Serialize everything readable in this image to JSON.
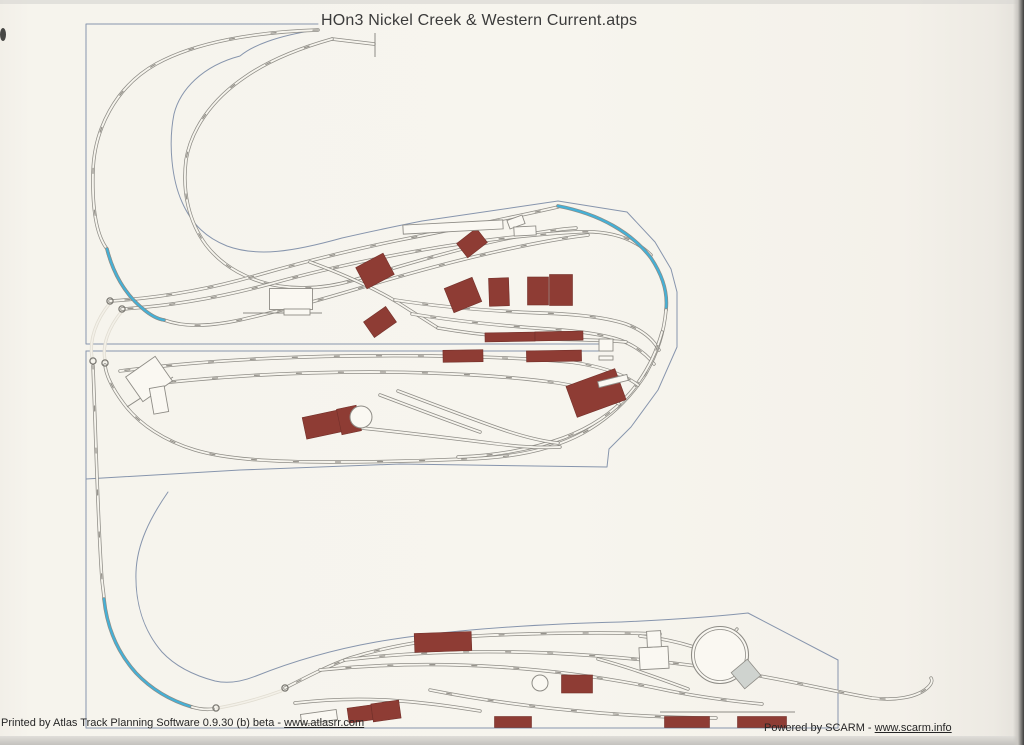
{
  "page": {
    "title": "HOn3 Nickel Creek & Western Current.atps"
  },
  "footer": {
    "left_prefix": "Printed by Atlas Track Planning Software 0.9.30 (b) beta - ",
    "left_link": "www.atlasrr.com",
    "right_prefix": "Powered by SCARM - ",
    "right_link": "www.scarm.info"
  },
  "colors": {
    "paper": "#f6f4ed",
    "paperLight": "#faf8f2",
    "rail": "#8e8c86",
    "blue": "#45b0d6",
    "ghost": "#e1ddd2",
    "ghostInner": "#f3f0e8",
    "outline": "#8795ad",
    "maroon": "#8e3c34",
    "maroonStroke": "#73302a",
    "grayFill": "#cfd3cf",
    "label": "#85817a"
  },
  "diagram": {
    "outlines": [
      {
        "d": "M 318,24 L 86,24 L 86,344 L 612,344"
      },
      {
        "d": "M 86,351 L 612,351"
      },
      {
        "d": "M 86,351 L 86,728 L 838,728 L 838,660"
      },
      {
        "d": "M 316,30 C 276,36 252,46 240,56 C 202,66 180,90 174,114 C 168,144 172,180 182,202 C 192,225 207,238 227,246 C 257,257 292,252 342,238 C 377,230 402,225 422,221 L 558,201 L 627,212 L 655,242 L 671,269 L 677,292 L 677,347 L 658,390 L 631,427 L 609,449 L 607,467 L 400,464 L 240,470 L 86,479"
      },
      {
        "d": "M 168,492 C 150,518 137,544 136,572 C 135,602 143,630 162,652 C 176,667 196,676 215,681 C 228,684 241,682 256,676 C 291,662 331,650 376,642 C 451,629 541,624 621,622 C 666,620 711,617 748,613 L 838,660"
      }
    ],
    "ghost_tracks": [
      {
        "d": "M 110,303 C 96,320 89,340 92,358"
      },
      {
        "d": "M 122,311 C 108,328 102,346 105,360"
      },
      {
        "d": "M 218,708 C 240,704 262,698 281,691"
      }
    ],
    "tracks": [
      {
        "d": "M 318,30 C 255,32 196,42 156,64 C 115,87 94,130 93,172 C 92,210 97,236 107,249 C 113,273 125,294 142,308 C 150,315 157,319 164,320 C 186,328 212,326 240,320 C 280,311 320,300 360,288 C 400,276 450,262 495,252 C 535,243 562,238 588,235",
        "k": "main",
        "labels": true
      },
      {
        "d": "M 332,39 L 374,44",
        "k": "main"
      },
      {
        "d": "M 332,39 C 300,48 268,61 245,77 C 211,100 191,130 186,160 C 182,192 189,222 206,245 C 223,267 249,281 279,286 C 306,290 331,287 354,280 C 400,266 460,248 510,238 C 540,232 560,229 576,228",
        "k": "main",
        "labels": true
      },
      {
        "d": "M 110,301 C 160,298 210,289 258,275 C 300,263 350,250 400,240 C 450,230 510,218 558,207",
        "k": "main",
        "labels": true
      },
      {
        "d": "M 122,309 C 172,306 222,297 270,284 C 320,270 380,257 440,247 C 490,239 540,234 576,232 C 610,230 634,238 651,255",
        "k": "main",
        "labels": true
      },
      {
        "d": "M 310,262 C 340,273 372,287 397,302 C 413,312 427,321 438,328",
        "k": "main"
      },
      {
        "d": "M 395,300 C 440,307 490,311 540,313 C 575,314 605,317 626,324 C 642,330 653,339 659,350",
        "k": "main",
        "labels": true
      },
      {
        "d": "M 412,314 C 455,321 505,326 548,329 C 578,331 602,334 620,340 C 636,346 647,355 654,364",
        "k": "main",
        "labels": true
      },
      {
        "d": "M 438,328 C 472,334 512,338 552,339 C 582,340 606,340 626,342",
        "k": "main"
      },
      {
        "d": "M 558,206 C 600,214 632,233 651,258 C 663,276 668,293 666,310",
        "k": "blue"
      },
      {
        "d": "M 107,249 C 113,273 125,294 142,308 C 150,315 157,319 164,320",
        "k": "blue"
      },
      {
        "d": "M 666,310 C 664,332 658,352 645,375 C 630,398 610,418 583,433 C 550,451 510,458 465,459 C 420,461 370,462 330,462 C 270,462 225,459 195,450 C 165,441 140,425 124,404 C 112,388 106,375 105,365",
        "k": "main",
        "labels": true
      },
      {
        "d": "M 662,332 C 656,354 646,374 630,393 C 613,413 590,428 563,438 C 530,450 492,456 458,457",
        "k": "main",
        "labels": true
      },
      {
        "d": "M 120,371 C 190,362 270,357 350,356 C 430,355 510,357 570,362 C 600,366 622,373 638,385",
        "k": "main",
        "labels": true
      },
      {
        "d": "M 135,386 C 210,377 290,372 370,372 C 440,372 508,376 558,383 C 584,387 604,394 619,404",
        "k": "main",
        "labels": true
      },
      {
        "d": "M 352,427 C 400,432 450,438 498,444 C 522,447 543,448 560,447",
        "k": "main"
      },
      {
        "d": "M 398,391 C 430,403 464,416 498,428 C 518,435 540,441 558,443",
        "k": "main"
      },
      {
        "d": "M 380,395 C 412,407 446,420 480,432",
        "k": "main"
      },
      {
        "d": "M 93,366 L 95,420 C 97,480 99,540 102,580 C 103,590 104,595 104,599",
        "k": "main",
        "labels": true
      },
      {
        "d": "M 104,599 C 107,628 118,653 136,673 C 153,691 172,701 192,707",
        "k": "blue"
      },
      {
        "d": "M 192,707 C 199,709 206,710 213,709",
        "k": "main"
      },
      {
        "d": "M 285,688 C 305,678 325,667 350,658 C 395,644 445,637 495,635 C 550,633 610,632 660,634",
        "k": "main",
        "labels": true
      },
      {
        "d": "M 640,636 C 660,638 678,642 694,647",
        "k": "main"
      },
      {
        "d": "M 345,660 C 410,652 480,650 550,653 C 630,657 700,665 760,676 C 800,683 842,693 872,698 C 896,701 916,697 926,689 C 931,685 933,681 931,678",
        "k": "main",
        "labels": true
      },
      {
        "d": "M 320,670 C 380,664 440,663 500,667 C 560,671 620,680 670,691 C 700,697 730,701 762,704",
        "k": "main",
        "labels": true
      },
      {
        "d": "M 430,690 C 480,700 540,708 600,713 C 640,716 682,718 716,718",
        "k": "main",
        "labels": true
      },
      {
        "d": "M 295,703 C 330,699 365,698 400,701 C 430,703 456,707 480,711",
        "k": "main"
      },
      {
        "d": "M 598,659 C 628,667 658,678 688,689",
        "k": "main"
      },
      {
        "d": "M 737,629 L 701,672",
        "k": "bridge"
      }
    ],
    "buildings": [
      {
        "cx": 472,
        "cy": 243,
        "w": 25,
        "h": 18,
        "rot": -38
      },
      {
        "cx": 375,
        "cy": 271,
        "w": 31,
        "h": 24,
        "rot": -28
      },
      {
        "cx": 463,
        "cy": 295,
        "w": 30,
        "h": 26,
        "rot": -22
      },
      {
        "cx": 499,
        "cy": 292,
        "w": 20,
        "h": 28,
        "rot": -2
      },
      {
        "cx": 538,
        "cy": 291,
        "w": 21,
        "h": 28,
        "rot": 0
      },
      {
        "cx": 561,
        "cy": 290,
        "w": 23,
        "h": 31,
        "rot": 0
      },
      {
        "cx": 380,
        "cy": 322,
        "w": 27,
        "h": 19,
        "rot": -35
      },
      {
        "cx": 510,
        "cy": 337,
        "w": 50,
        "h": 9,
        "rot": -1
      },
      {
        "cx": 559,
        "cy": 336,
        "w": 48,
        "h": 9,
        "rot": -1
      },
      {
        "cx": 463,
        "cy": 356,
        "w": 40,
        "h": 12,
        "rot": -1
      },
      {
        "cx": 554,
        "cy": 356,
        "w": 55,
        "h": 11,
        "rot": -1
      },
      {
        "cx": 596,
        "cy": 393,
        "w": 52,
        "h": 33,
        "rot": -20
      },
      {
        "cx": 325,
        "cy": 424,
        "w": 42,
        "h": 22,
        "rot": -12
      },
      {
        "cx": 349,
        "cy": 420,
        "w": 20,
        "h": 26,
        "rot": -12
      },
      {
        "cx": 443,
        "cy": 642,
        "w": 57,
        "h": 19,
        "rot": -2
      },
      {
        "cx": 577,
        "cy": 684,
        "w": 31,
        "h": 18,
        "rot": 0
      },
      {
        "cx": 360,
        "cy": 714,
        "w": 24,
        "h": 15,
        "rot": -8
      },
      {
        "cx": 386,
        "cy": 711,
        "w": 28,
        "h": 18,
        "rot": -8
      },
      {
        "cx": 513,
        "cy": 722,
        "w": 37,
        "h": 11,
        "rot": 0
      },
      {
        "cx": 687,
        "cy": 722,
        "w": 45,
        "h": 11,
        "rot": 0
      },
      {
        "cx": 762,
        "cy": 722,
        "w": 49,
        "h": 11,
        "rot": 0
      }
    ],
    "structures": [
      {
        "cx": 453,
        "cy": 227,
        "w": 100,
        "h": 9,
        "rot": -3,
        "fill": "white"
      },
      {
        "cx": 516,
        "cy": 222,
        "w": 16,
        "h": 9,
        "rot": -20,
        "fill": "white"
      },
      {
        "cx": 525,
        "cy": 231,
        "w": 22,
        "h": 9,
        "rot": -3,
        "fill": "white"
      },
      {
        "cx": 291,
        "cy": 299,
        "w": 43,
        "h": 21,
        "rot": 0,
        "fill": "white"
      },
      {
        "cx": 297,
        "cy": 312,
        "w": 26,
        "h": 6,
        "rot": 0,
        "fill": "white"
      },
      {
        "cx": 149,
        "cy": 379,
        "w": 36,
        "h": 30,
        "rot": -35,
        "fill": "white"
      },
      {
        "cx": 159,
        "cy": 400,
        "w": 15,
        "h": 26,
        "rot": -10,
        "fill": "white"
      },
      {
        "cx": 606,
        "cy": 345,
        "w": 14,
        "h": 12,
        "rot": 0,
        "fill": "white"
      },
      {
        "cx": 606,
        "cy": 358,
        "w": 14,
        "h": 4,
        "rot": 0,
        "fill": "white"
      },
      {
        "cx": 613,
        "cy": 381,
        "w": 30,
        "h": 6,
        "rot": -14,
        "fill": "white"
      },
      {
        "cx": 654,
        "cy": 658,
        "w": 29,
        "h": 22,
        "rot": -3,
        "fill": "white"
      },
      {
        "cx": 654,
        "cy": 639,
        "w": 14,
        "h": 16,
        "rot": -3,
        "fill": "white"
      },
      {
        "cx": 319,
        "cy": 717,
        "w": 36,
        "h": 10,
        "rot": -8,
        "fill": "white"
      }
    ],
    "tanks": [
      {
        "cx": 361,
        "cy": 417,
        "r": 11
      },
      {
        "cx": 540,
        "cy": 683,
        "r": 8
      }
    ],
    "turntable": {
      "cx": 720,
      "cy": 655,
      "r_outer": 28.5,
      "r_inner": 25.5,
      "shed": {
        "cx": 746,
        "cy": 674,
        "w": 21,
        "h": 21,
        "rot": -40
      }
    },
    "bumpers": [
      {
        "cx": 110,
        "cy": 301
      },
      {
        "cx": 122,
        "cy": 309
      },
      {
        "cx": 93,
        "cy": 361
      },
      {
        "cx": 105,
        "cy": 363
      },
      {
        "cx": 216,
        "cy": 708
      },
      {
        "cx": 285,
        "cy": 688
      }
    ],
    "misc_lines": [
      {
        "x1": 375,
        "y1": 33,
        "x2": 375,
        "y2": 57
      },
      {
        "x1": 127,
        "y1": 407,
        "x2": 173,
        "y2": 377
      },
      {
        "x1": 243,
        "y1": 313,
        "x2": 322,
        "y2": 313
      },
      {
        "x1": 660,
        "y1": 712,
        "x2": 795,
        "y2": 712
      }
    ]
  }
}
